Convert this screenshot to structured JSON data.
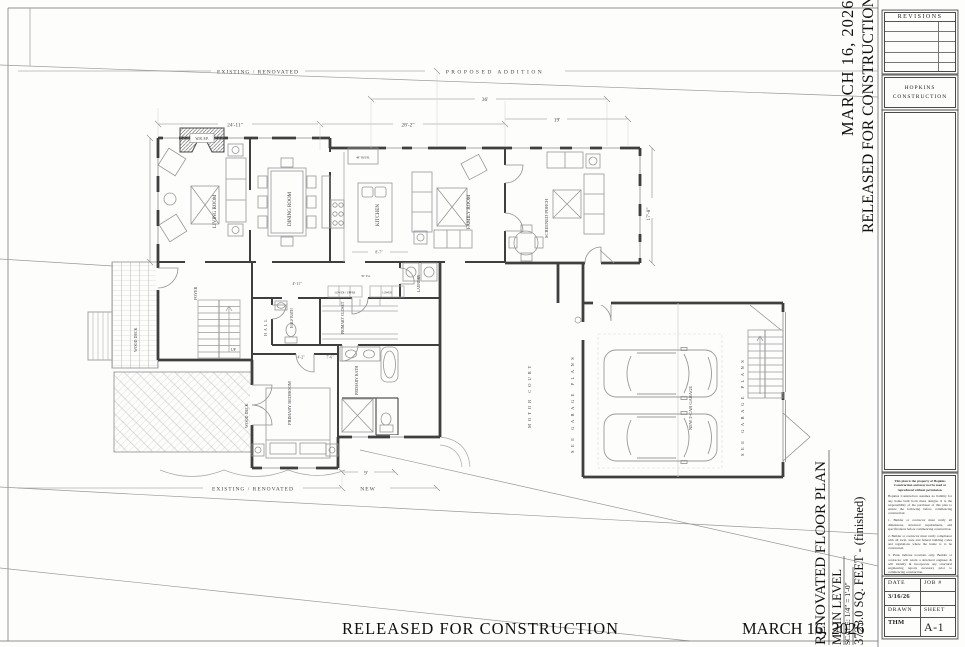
{
  "sheet": {
    "stamp_date": "MARCH 16, 2026",
    "stamp_released": "RELEASED FOR CONSTRUCTION",
    "bottom_released": "RELEASED FOR CONSTRUCTION",
    "bottom_date": "MARCH 16, 2026"
  },
  "plan_title": {
    "line1": "RENOVATED FLOOR PLAN",
    "line2": "MAIN LEVEL",
    "scale": "SCALE: 1/4\" = 1'-0\"",
    "area": "3723.0 SQ. FEET - (finished)"
  },
  "zones": {
    "existing_top": "EXISTING / RENOVATED",
    "proposed": "PROPOSED ADDITION",
    "existing_bottom": "EXISTING / RENOVATED",
    "new": "NEW"
  },
  "dims": {
    "top_main": "24'-11\"",
    "top_addition": "28'-2\"",
    "top_porch": "19'",
    "top_overall": "36'",
    "bottom_new": "9'",
    "porch_height": "17'-8\"",
    "hall_width": "8'-7\"",
    "foyer_width": "4'-11\"",
    "bath_a": "4'-2\"",
    "bath_b": "7'-6\"",
    "cabinet": "30\" EA."
  },
  "rooms": {
    "living": "LIVING ROOM",
    "dining": "DINING ROOM",
    "kitchen": "KITCHEN",
    "family": "FAMILY ROOM",
    "porch": "SCREENED PORCH",
    "foyer": "FOYER",
    "hall": "HALL",
    "half_bath": "HALF BATH",
    "closet": "PRIMARY CLOSET",
    "laundry": "LAUNDRY",
    "bedroom": "PRIMARY BEDROOM",
    "bath": "PRIMARY BATH",
    "deck_upper": "WOOD DECK",
    "deck_lower": "WOOD DECK",
    "motor_court": "MOTOR COURT",
    "garage": "NEW 2-CAR GARAGE",
    "stairs_up": "UP",
    "fireplace": "W.B. F.P.",
    "refrigerator": "48\" REFR.",
    "cab_lower_upper": "LOWER / UPPER",
    "cab_lower": "LOWER",
    "garage_note_left": "SEE GARAGE PLANS",
    "garage_note_right": "SEE GARAGE PLANS"
  },
  "titleblock": {
    "revisions_label": "REVISIONS",
    "firm_line1": "HOPKINS",
    "firm_line2": "CONSTRUCTION",
    "project_for": "A RENOVATION & ADDITIONS FOR",
    "project_name": "HOPKINS CONSTRUCTION",
    "address_left": "230 CHEROKEE AVE",
    "address_right": "ATHENS, GA 30601",
    "notes": [
      "This plan is the property of Hopkins Construction and may not be used or reproduced without permission.",
      "Hopkins Construction assumes no liability for any home built from these designs. It is the responsibility of the purchaser of this plan to ensure the following before commencing construction:",
      "1.  Builder or contractor must verify all dimensions, structural requirements, and specifications before commencing construction.",
      "2.  Builder or contractor must verify compliance with all local, state and federal building codes and regulations where the home is to be constructed.",
      "3.  Plans indicate locations only. Builder or contractor will retain a structural engineer & will identify & incorporate any structural engineering reports necessary prior to commencing construction.",
      "Great care must be exercised in making any changes to this plan. Only a qualified designer, architect, or structural engineer should make changes to this plan."
    ],
    "date_label": "DATE",
    "job_label": "JOB #",
    "date_value": "3/16/26",
    "drawn_label": "DRAWN",
    "sheet_label": "SHEET",
    "drawn_value": "THM",
    "sheet_value": "A-1"
  }
}
